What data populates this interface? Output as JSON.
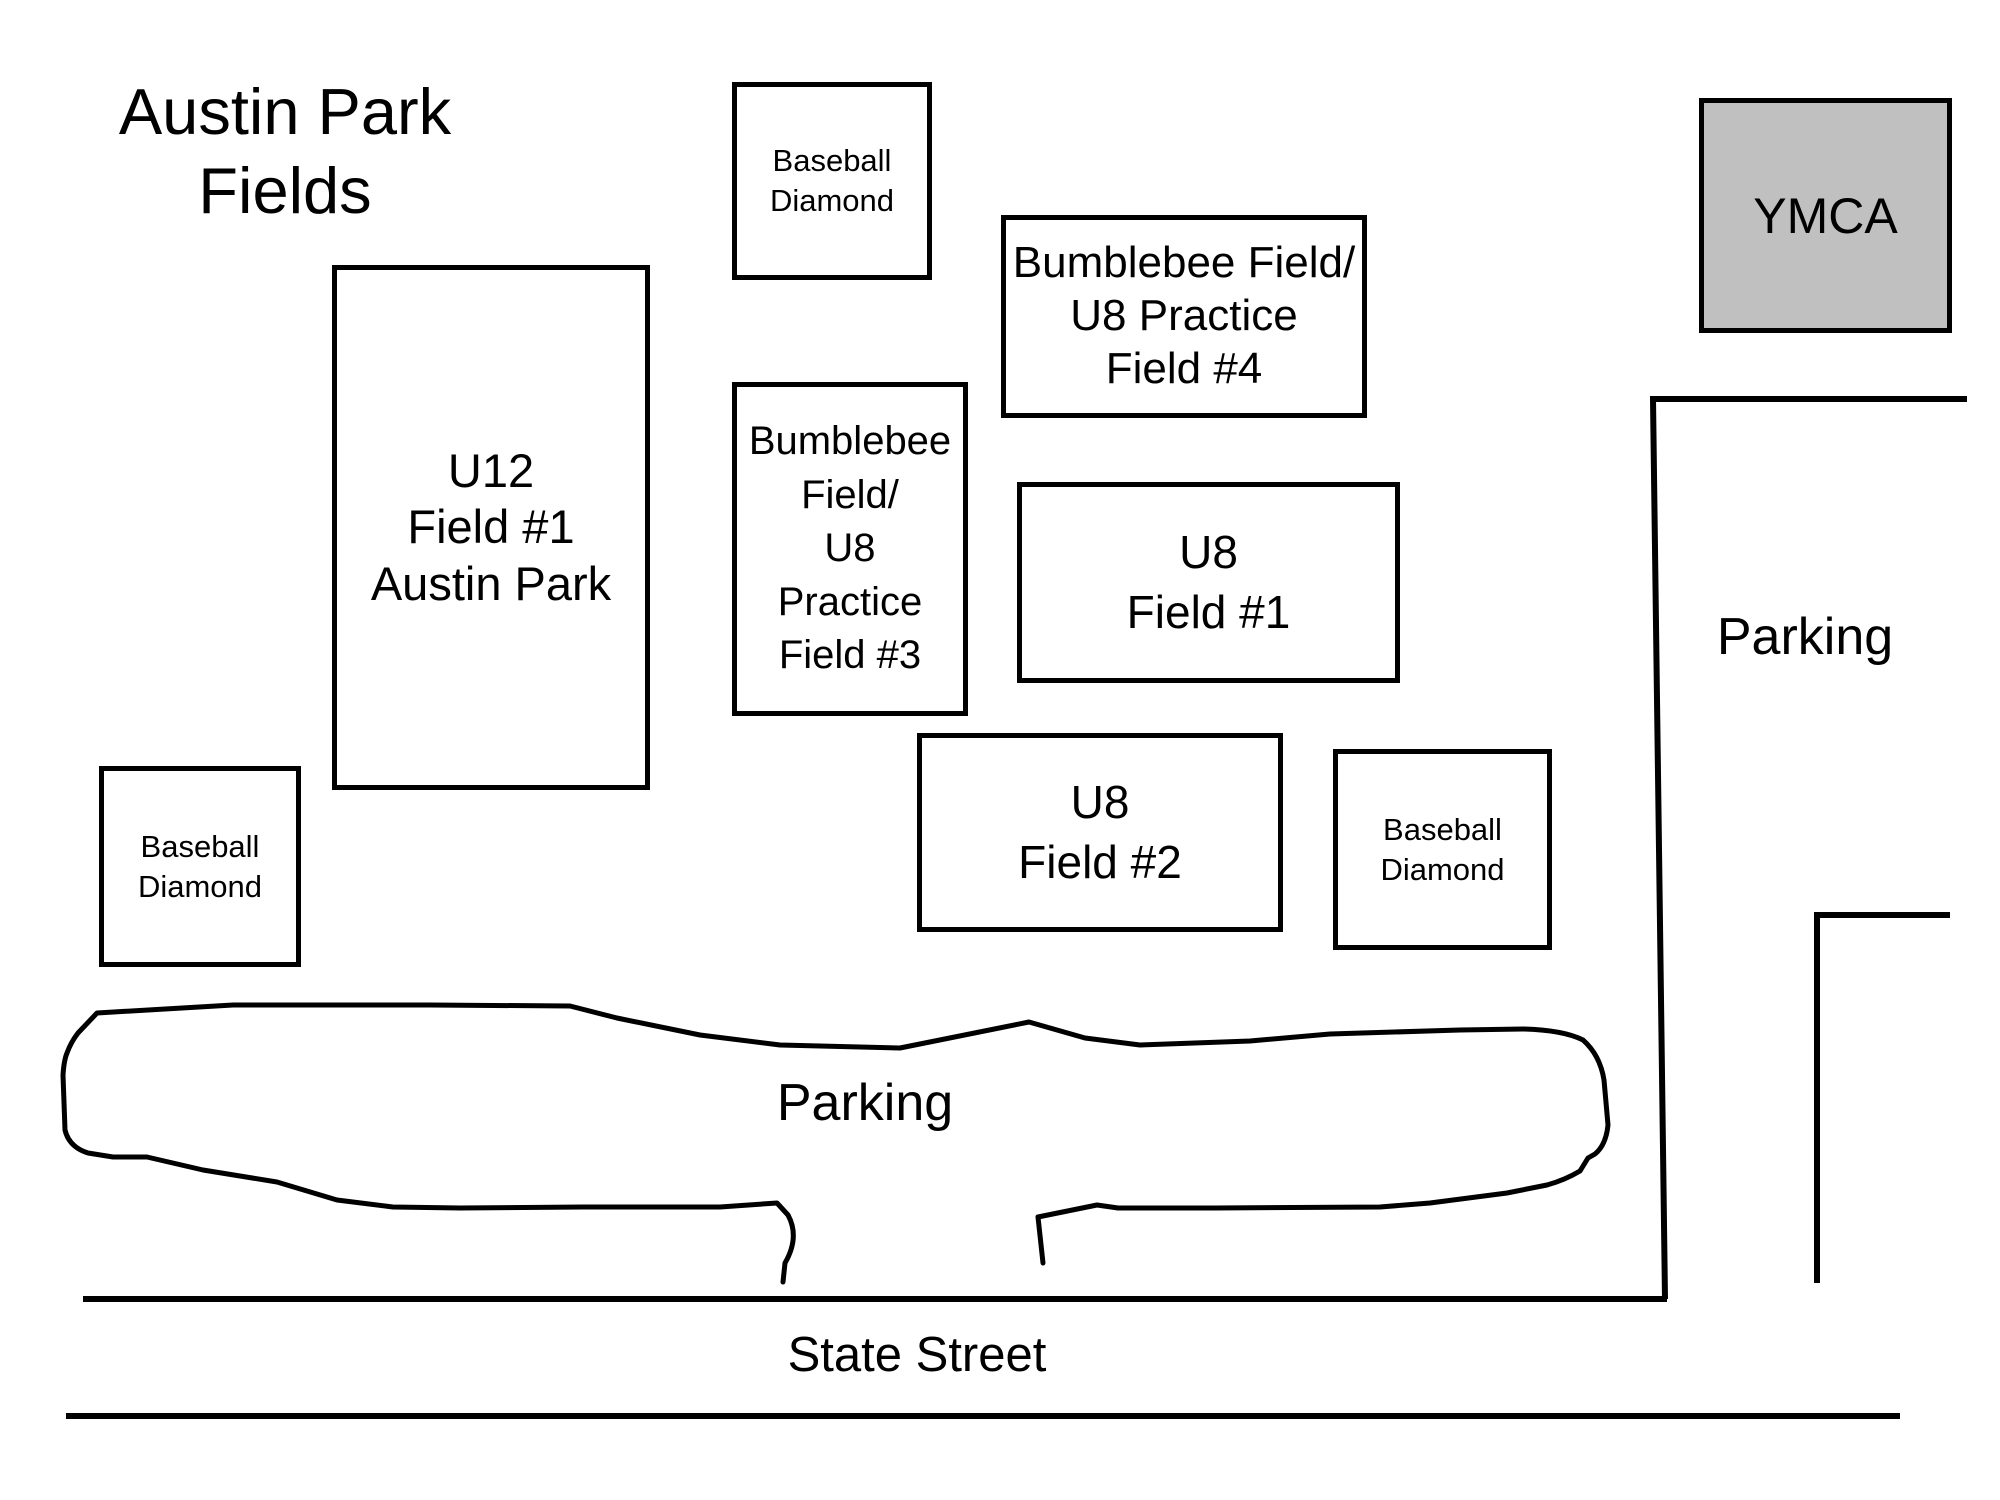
{
  "title": "Austin Park\nFields",
  "boxes": {
    "baseball_top": {
      "label": "Baseball\nDiamond"
    },
    "ymca": {
      "label": "YMCA"
    },
    "bumblebee_field4": {
      "label": "Bumblebee Field/\nU8 Practice\nField #4"
    },
    "u12_field1": {
      "label": "U12\nField #1\nAustin Park"
    },
    "bumblebee_field3": {
      "label": "Bumblebee\nField/\nU8\nPractice\nField #3"
    },
    "u8_field1": {
      "label": "U8\nField #1"
    },
    "u8_field2": {
      "label": "U8\nField #2"
    },
    "baseball_right": {
      "label": "Baseball\nDiamond"
    },
    "baseball_left": {
      "label": "Baseball\nDiamond"
    }
  },
  "labels": {
    "parking_main": "Parking",
    "parking_east": "Parking",
    "street": "State Street"
  },
  "colors": {
    "outline": "#000000",
    "ymca_fill": "#c0c0c0",
    "background": "#ffffff"
  }
}
